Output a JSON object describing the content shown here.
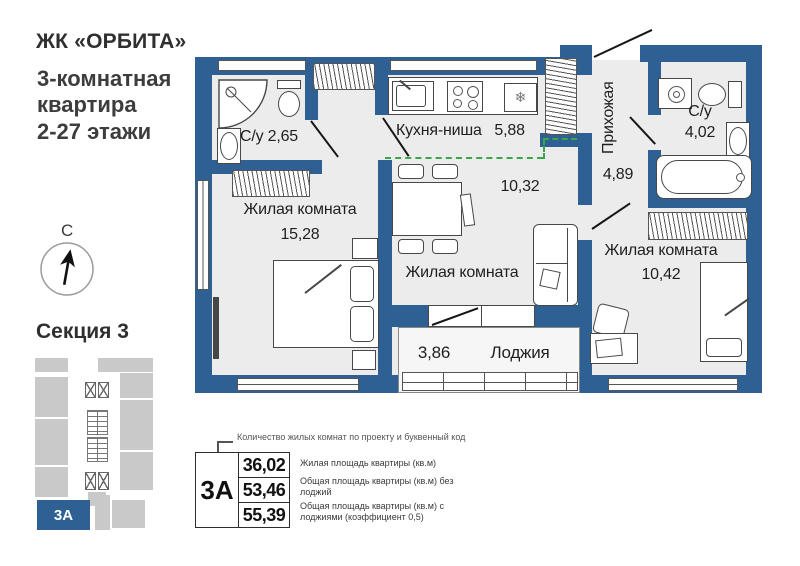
{
  "header": {
    "complex_name": "ЖК «ОРБИТА»",
    "subtitle_lines": [
      "3-комнатная",
      "квартира",
      "2-27 этажи"
    ]
  },
  "compass": {
    "north": "С"
  },
  "section": {
    "title": "Секция 3",
    "highlight_unit": "3А"
  },
  "plan": {
    "bath_small": {
      "name": "С/у",
      "area": "2,65"
    },
    "kitchen": {
      "name": "Кухня-ниша",
      "area": "5,88"
    },
    "hallway": {
      "name": "Прихожая",
      "area": "4,89"
    },
    "bath_big": {
      "name": "С/у",
      "area": "4,02"
    },
    "room_left": {
      "name": "Жилая комната",
      "area": "15,28"
    },
    "room_middle": {
      "name": "Жилая комната",
      "area": "10,32"
    },
    "room_right": {
      "name": "Жилая комната",
      "area": "10,42"
    },
    "loggia": {
      "name": "Лоджия",
      "area": "3,86"
    }
  },
  "icons": {
    "fridge_snowflake": "❄"
  },
  "legend": {
    "callout": "Количество жилых комнат по проекту и буквенный код",
    "unit_code": "3А",
    "rows": [
      {
        "value": "36,02",
        "label": "Жилая площадь квартиры (кв.м)"
      },
      {
        "value": "53,46",
        "label": "Общая площадь квартиры (кв.м) без лоджий"
      },
      {
        "value": "55,39",
        "label": "Общая площадь квартиры (кв.м) с лоджиями (коэффициент 0,5)"
      }
    ]
  },
  "colors": {
    "wall": "#2e6093",
    "floor": "#ececec",
    "green_dashed": "#3ba648",
    "mini_gray": "#c9c9c9"
  }
}
